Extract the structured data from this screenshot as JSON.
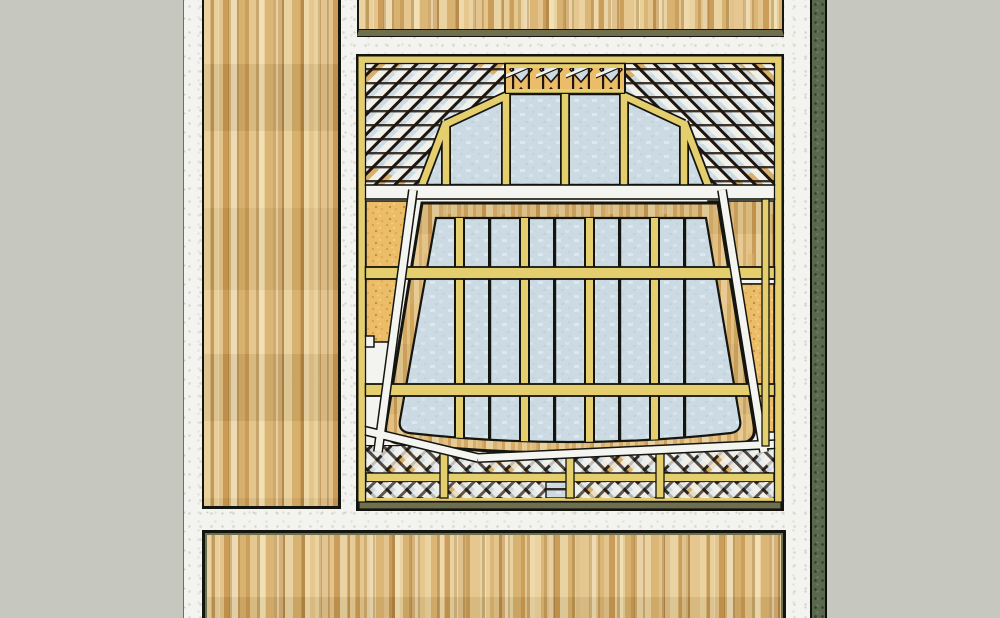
{
  "scene": {
    "type": "3d-architectural-model-render",
    "view": "elevation of a timber-framed wall with a large trapezoidal glazed window, latticework transom and sill bands, flanked by plain wood panels",
    "components": [
      {
        "name": "background-wall"
      },
      {
        "name": "plaster-wall"
      },
      {
        "name": "left-wood-panel"
      },
      {
        "name": "top-wood-panel"
      },
      {
        "name": "bottom-wood-panel"
      },
      {
        "name": "green-trim-board"
      },
      {
        "name": "framed-opening-structure"
      },
      {
        "name": "top-lattice-band"
      },
      {
        "name": "frieze-band"
      },
      {
        "name": "arched-glass-transom"
      },
      {
        "name": "white-rail"
      },
      {
        "name": "cork-infill-panels"
      },
      {
        "name": "main-glazed-window"
      },
      {
        "name": "diagonal-braces"
      },
      {
        "name": "bottom-lattice-band"
      }
    ]
  },
  "palette": {
    "bg": "#c6c7bf",
    "plaster": "#f3f3ef",
    "plaster_dot": "#d8d8d1",
    "wood_base": "#dcba7e",
    "wood_light": "#e9d09a",
    "wood_mid": "#d9b26e",
    "wood_dark": "#c79750",
    "olive": "#6e6f4f",
    "green": "#5a694e",
    "green_dot": "#35432f",
    "frame_yellow": "#e4ce6e",
    "outline": "#15150f",
    "glass": "#ccdae3",
    "glass_light": "#dde7ee",
    "cork": "#ecbd69",
    "cork_dot": "#d79e41",
    "white_trim": "#f4f4f1",
    "lattice_dark": "#20150c",
    "wood_band": "#d9b478"
  }
}
